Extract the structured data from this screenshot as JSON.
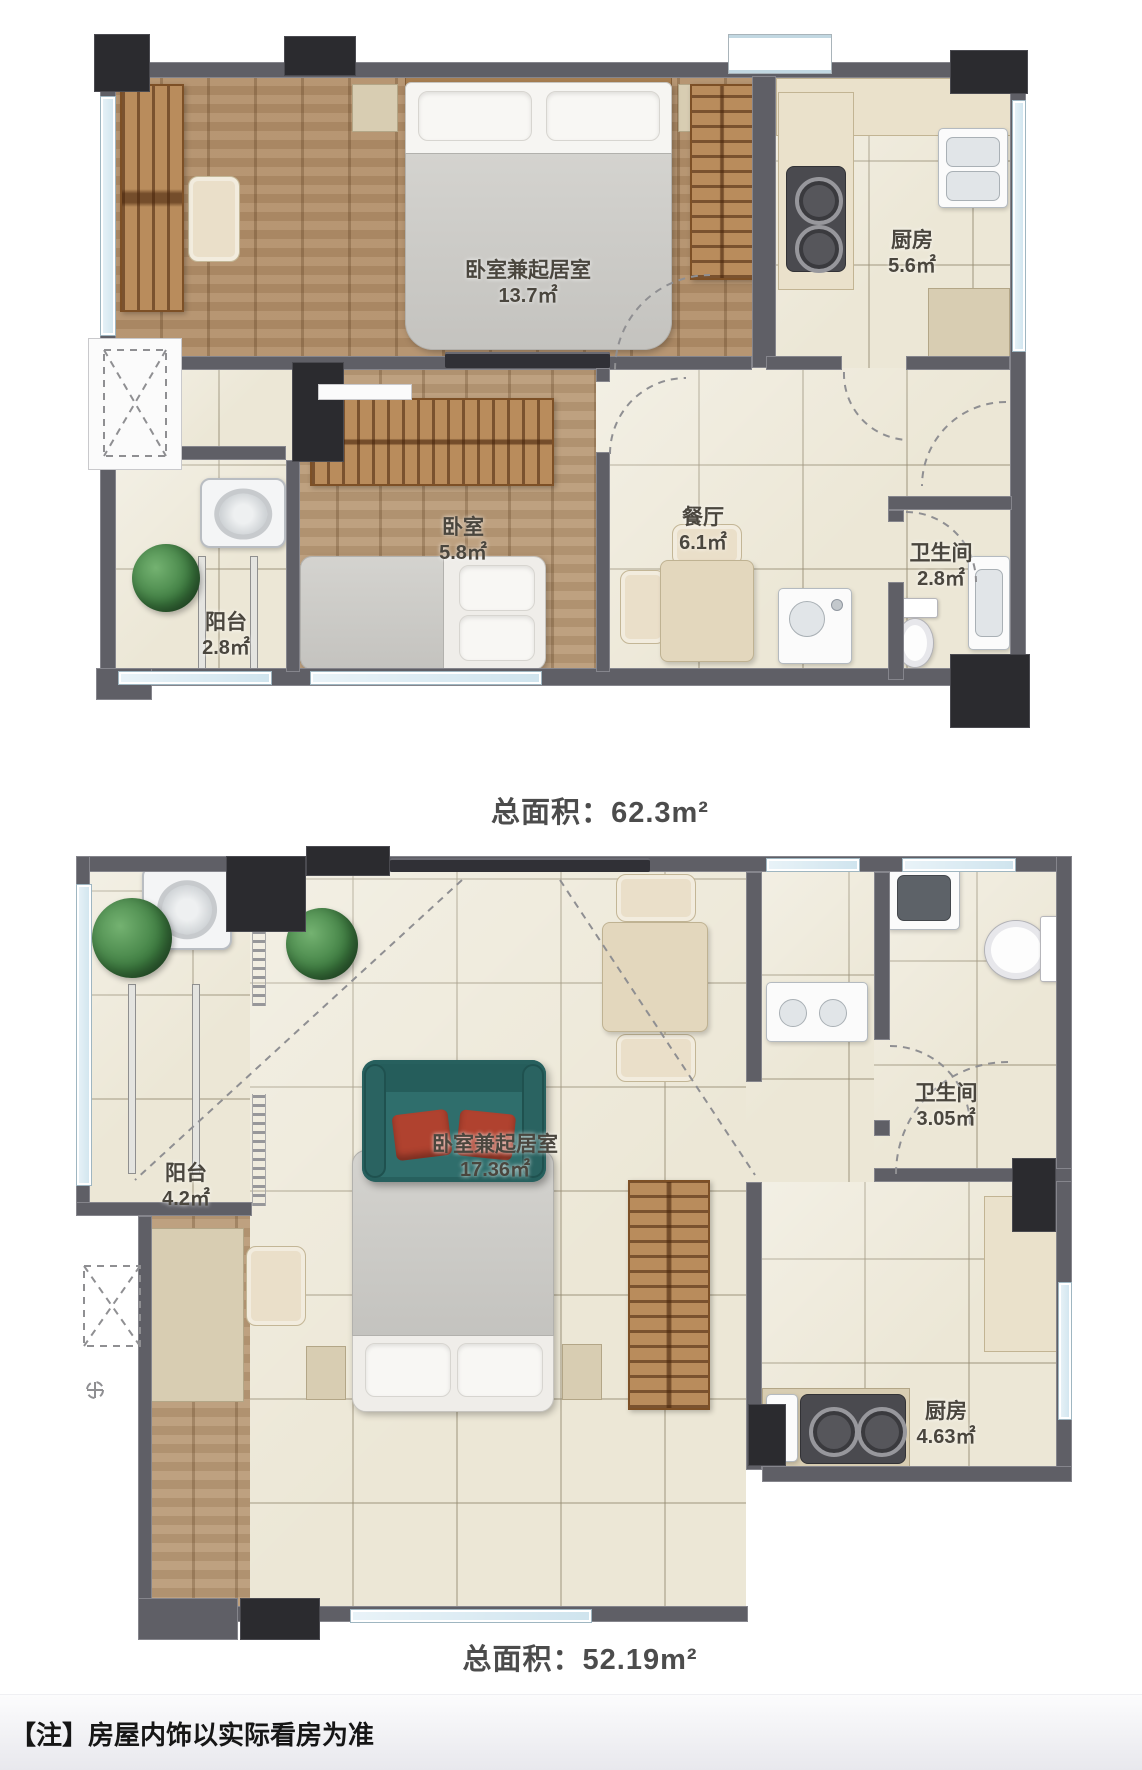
{
  "footer": {
    "note_prefix": "【注】",
    "note_text": "房屋内饰以实际看房为准"
  },
  "plans": [
    {
      "id": "plan-1",
      "total_prefix": "总面积：",
      "total_value": "62.3m²",
      "rooms": {
        "main": {
          "label": "卧室兼起居室",
          "area": "13.7㎡"
        },
        "kitchen": {
          "label": "厨房",
          "area": "5.6㎡"
        },
        "dining": {
          "label": "餐厅",
          "area": "6.1㎡"
        },
        "bedroom": {
          "label": "卧室",
          "area": "5.8㎡"
        },
        "balcony": {
          "label": "阳台",
          "area": "2.8㎡"
        },
        "bathroom": {
          "label": "卫生间",
          "area": "2.8㎡"
        }
      }
    },
    {
      "id": "plan-2",
      "total_prefix": "总面积：",
      "total_value": "52.19m²",
      "rooms": {
        "main": {
          "label": "卧室兼起居室",
          "area": "17.36㎡"
        },
        "bathroom": {
          "label": "卫生间",
          "area": "3.05㎡"
        },
        "balcony": {
          "label": "阳台",
          "area": "4.2㎡"
        },
        "kitchen": {
          "label": "厨房",
          "area": "4.63㎡"
        }
      }
    }
  ],
  "colors": {
    "wall": "#5f5f66",
    "column": "#2b2b2f",
    "wood_floor": "#b28e68",
    "tile_floor": "#ece7d6",
    "counter": "#d8cdb2",
    "sofa": "#2f6e6c",
    "cushion": "#b0422f",
    "plant": "#3d7c40",
    "window": "#cfe4ee"
  }
}
